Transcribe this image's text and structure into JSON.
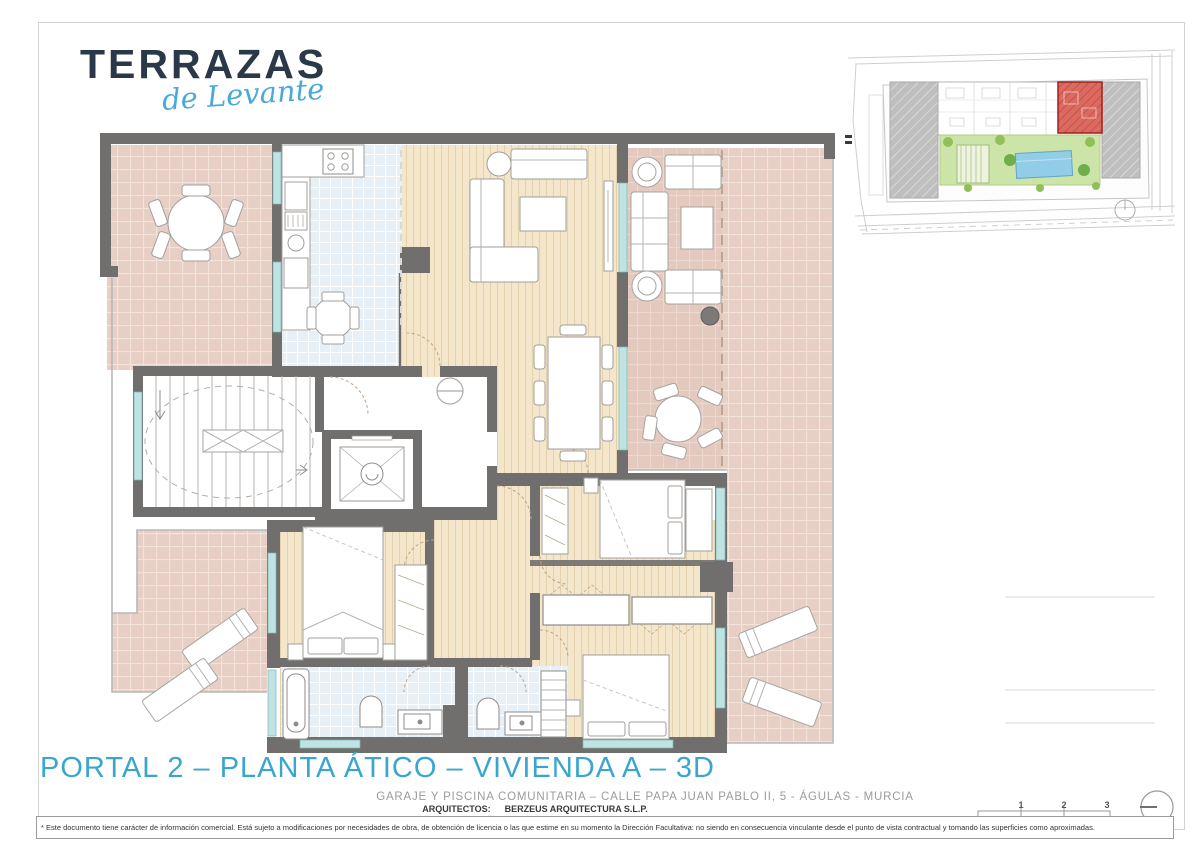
{
  "logo": {
    "name": "TERRAZAS",
    "tagline": "de Levante"
  },
  "title": "PORTAL 2 – PLANTA ÁTICO – VIVIENDA A – 3D",
  "footer": {
    "address": "GARAJE Y PISCINA COMUNITARIA – CALLE PAPA JUAN PABLO II, 5 - ÁGULAS - MURCIA",
    "architects_label": "ARQUITECTOS:",
    "architects_name": "BERZEUS ARQUITECTURA S.L.P.",
    "disclaimer": "* Este documento tiene carácter de información comercial. Está sujeto a modificaciones por necesidades de obra, de obtención de licencia o las que estime en su momento la Dirección Facultativa: no siendo en consecuencia vinculante desde el punto de vista contractual y tomando las superficies como aproximadas."
  },
  "scale_bar": {
    "labels": [
      "1",
      "2",
      "3"
    ]
  },
  "colors": {
    "accent_blue": "#3aa6cf",
    "logo_navy": "#2b3847",
    "script_blue": "#4aa9d8",
    "wall_gray": "#706f6d",
    "terrace_tile": "#e7cfc5",
    "kitchen_tile": "#e7f0f6",
    "wood_floor": "#f4e6cb",
    "window_teal": "#aadbd8",
    "site_highlight_red": "#cc4438",
    "pool_blue": "#8ecbe4",
    "garden_green": "#b8d98d"
  }
}
